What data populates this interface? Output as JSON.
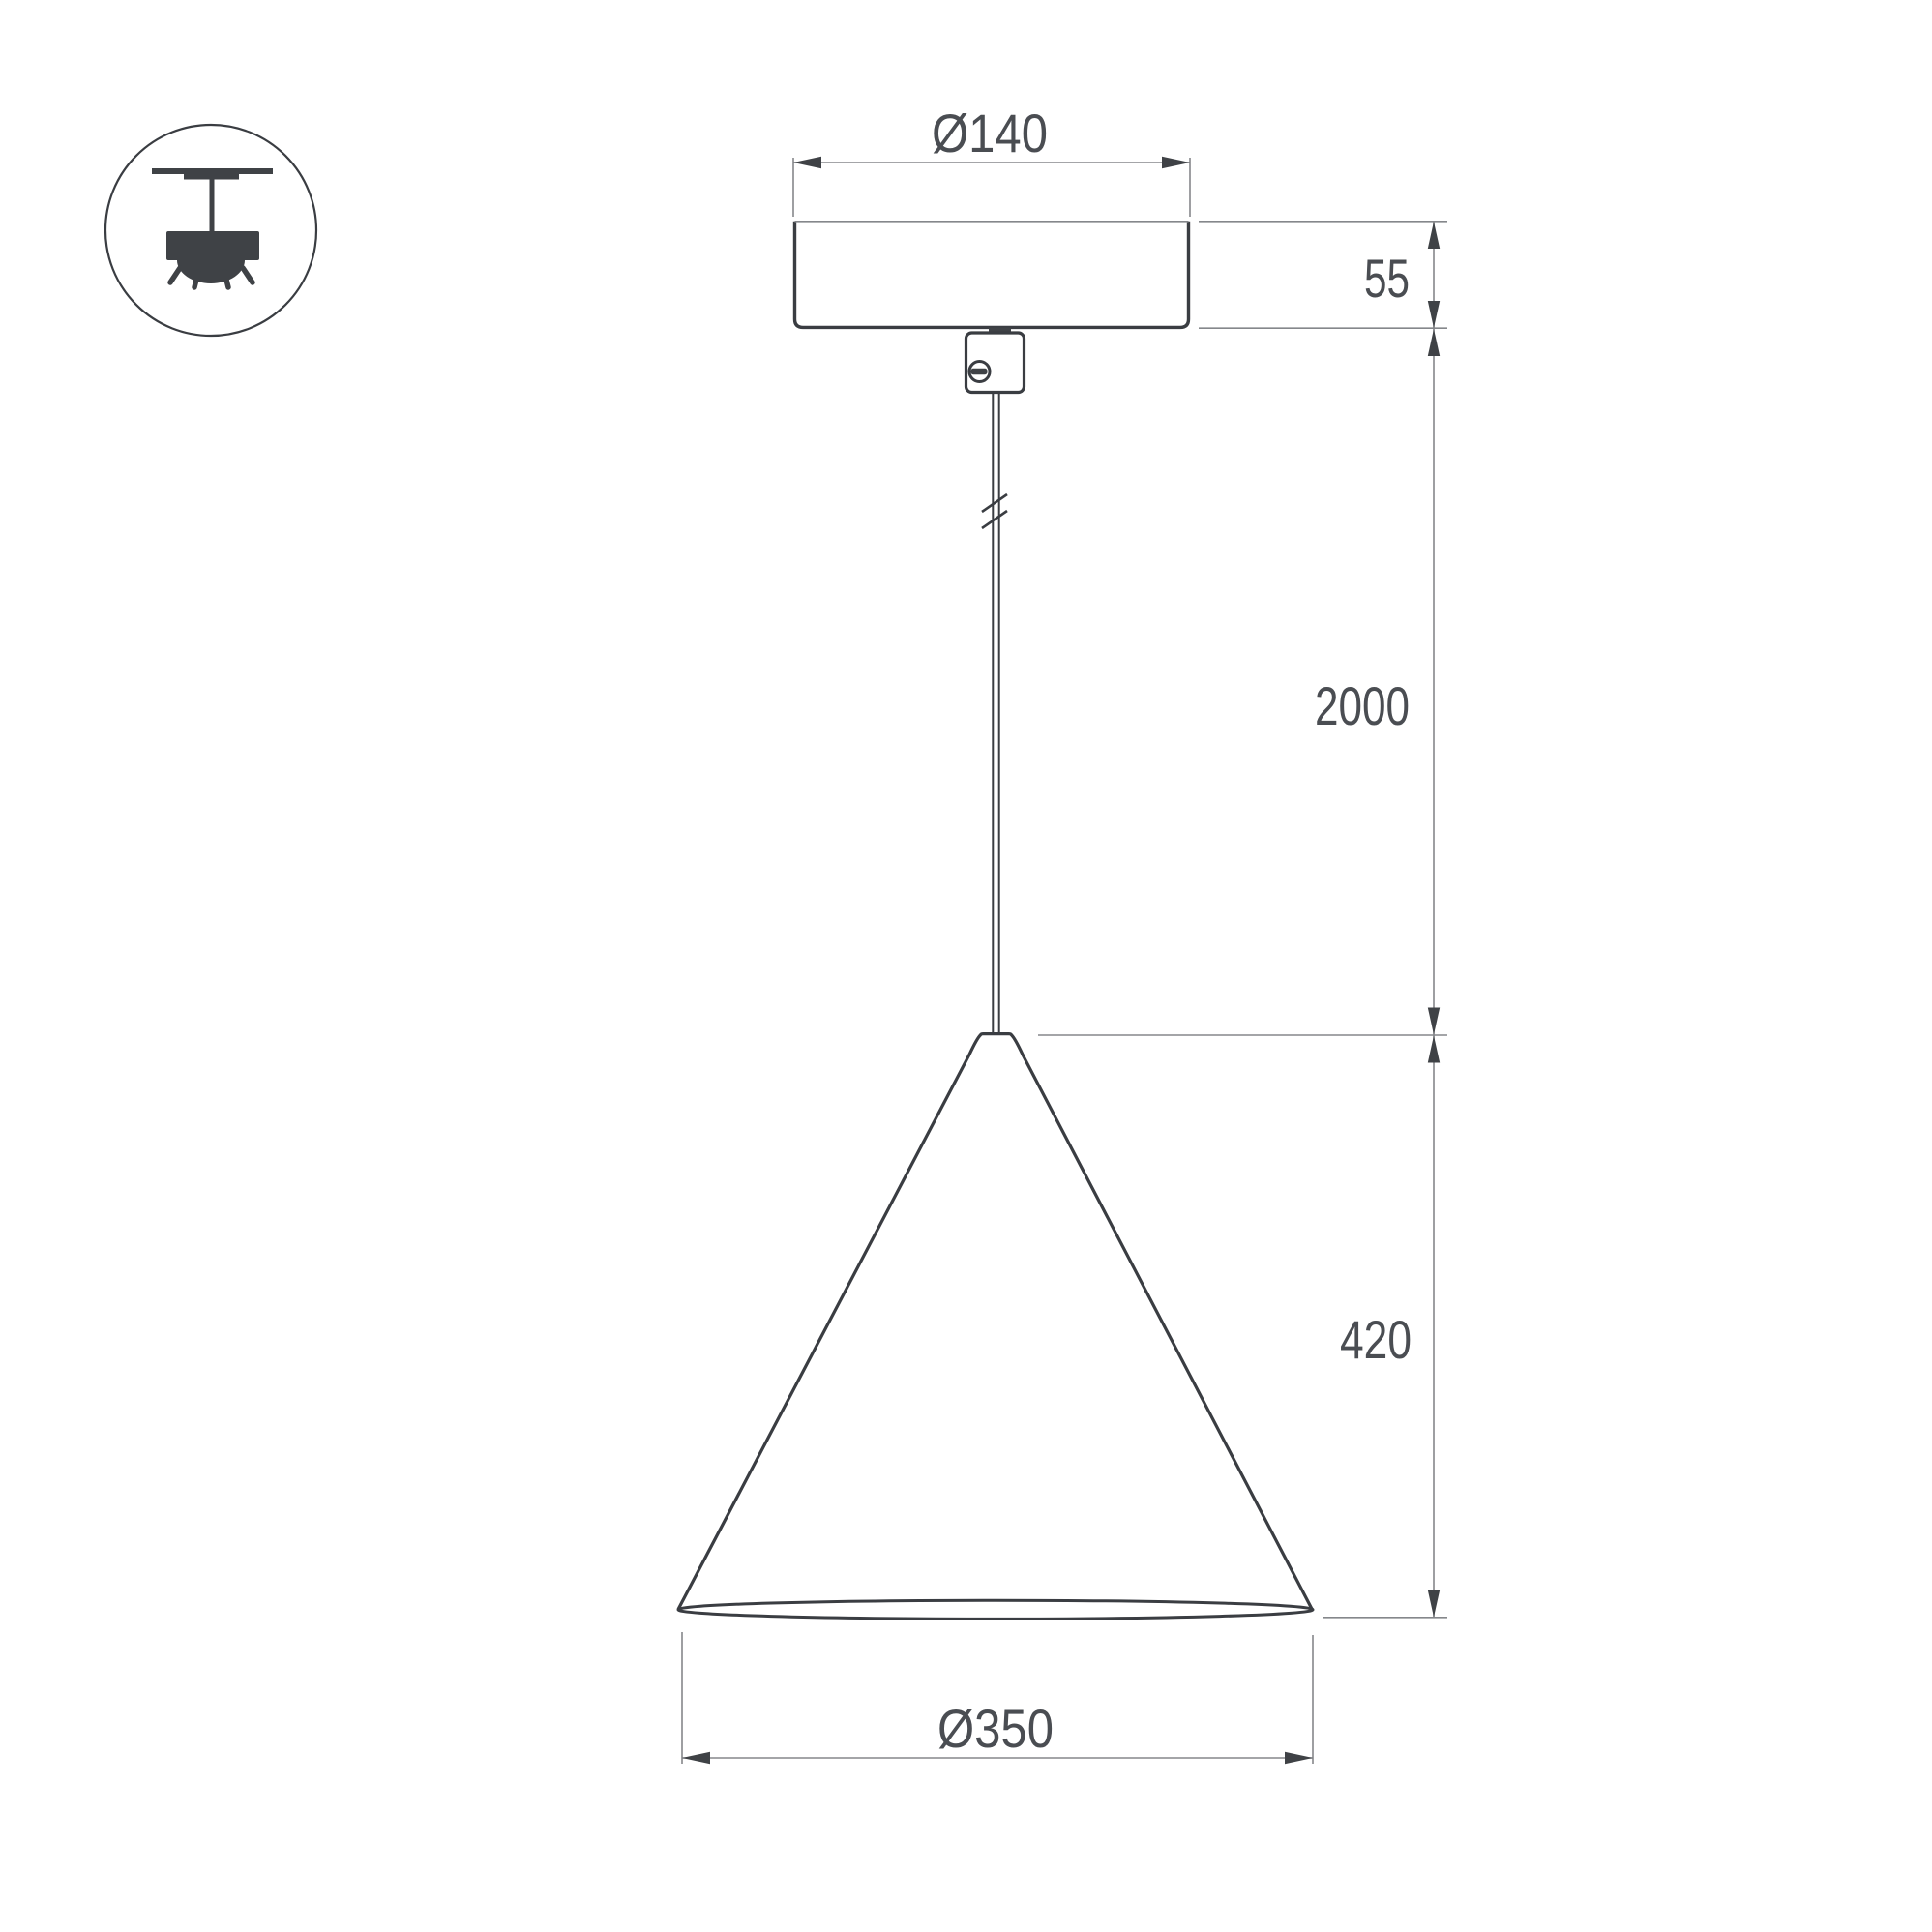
{
  "title": "Pendant lamp dimensional drawing",
  "colors": {
    "background": "#ffffff",
    "object_line": "#3a3d42",
    "dimension_line": "#85878b",
    "label_text": "#4a4d52"
  },
  "icon": {
    "name": "ceiling-pendant-mount-icon"
  },
  "labels": {
    "canopy_diameter": "Ø140",
    "canopy_height": "55",
    "suspension_length": "2000",
    "shade_height": "420",
    "shade_diameter": "Ø350"
  }
}
